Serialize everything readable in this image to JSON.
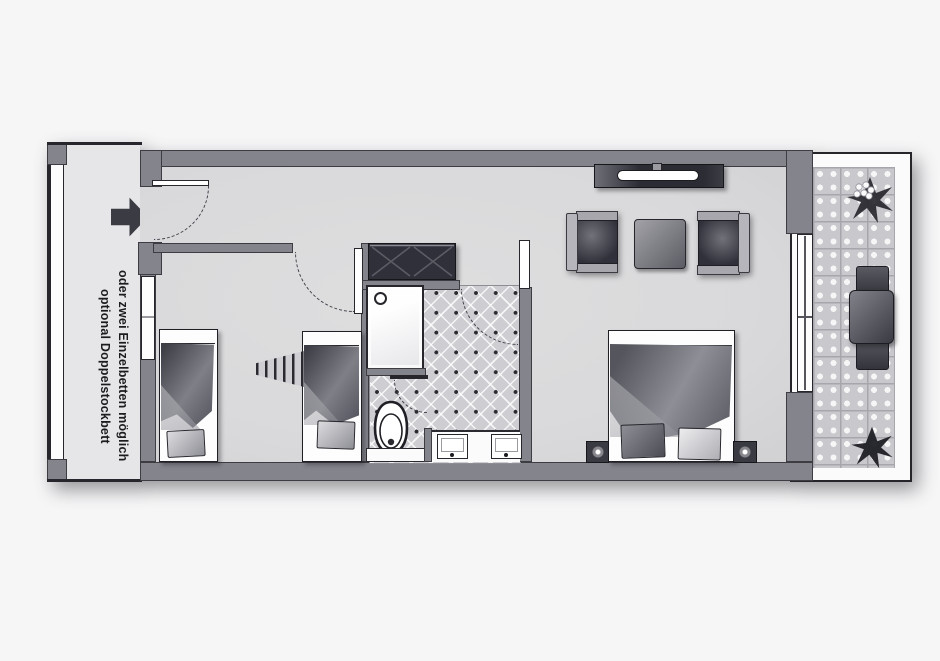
{
  "annotation": {
    "line1": "optional Doppelstockbett",
    "line2": "oder zwei Einzelbetten möglich"
  },
  "icons": {
    "entrance-arrow": "arrow-right"
  },
  "colors": {
    "background": "#f6f6f7",
    "wall": "#84848c",
    "wall_outline": "#3c3c42",
    "floor": "#d9d9db",
    "corridor_floor": "#e6e6e8",
    "tile": "#cdcdd2",
    "accent_dark": "#26262c",
    "dark_furniture": "#30303a",
    "text": "#1c1c1e"
  }
}
